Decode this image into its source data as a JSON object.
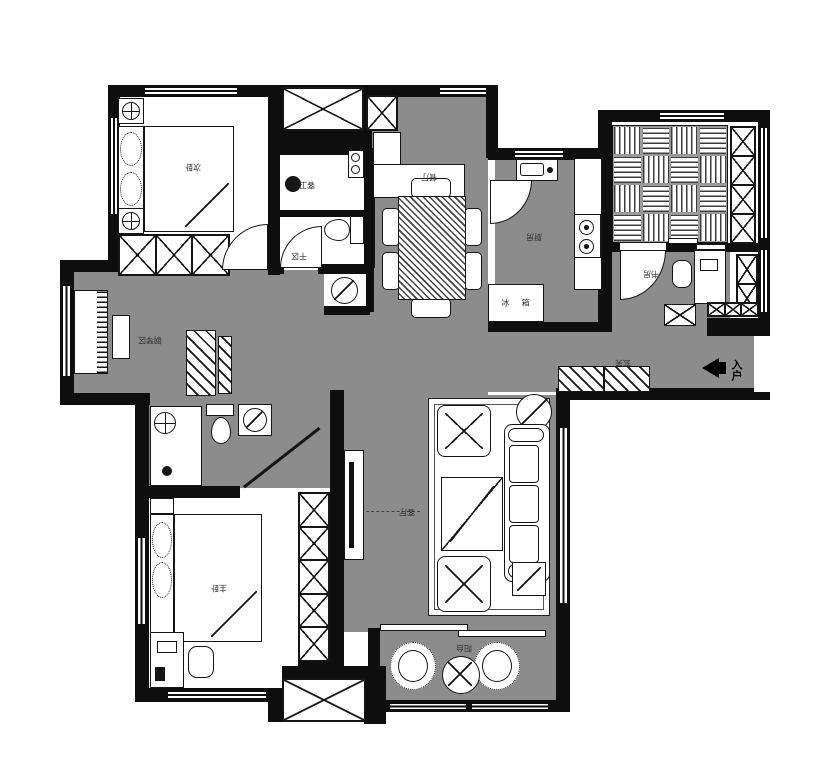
{
  "meta": {
    "type": "apartment-floor-plan",
    "canvas_width": 827,
    "canvas_height": 780
  },
  "colors": {
    "wall": "#0e0e0e",
    "public_floor": "#8c8c8c",
    "room_floor": "#ffffff"
  },
  "rooms": {
    "secondary_bedroom": {
      "label": "次卧"
    },
    "guest_bathroom": {
      "label": "客卫"
    },
    "dry_area": {
      "label": "干区"
    },
    "dining_room": {
      "label": "餐厅"
    },
    "kitchen": {
      "label": "厨房"
    },
    "fridge": {
      "label": "冰 箱"
    },
    "study": {
      "label": "书房"
    },
    "foyer": {
      "label": "玄关"
    },
    "entry_arrow": {
      "label": "入户"
    },
    "piano_area": {
      "label": "钢琴区"
    },
    "master_bedroom": {
      "label": "主卧"
    },
    "living_room": {
      "label": "客厅"
    },
    "balcony": {
      "label": "阳台"
    }
  }
}
